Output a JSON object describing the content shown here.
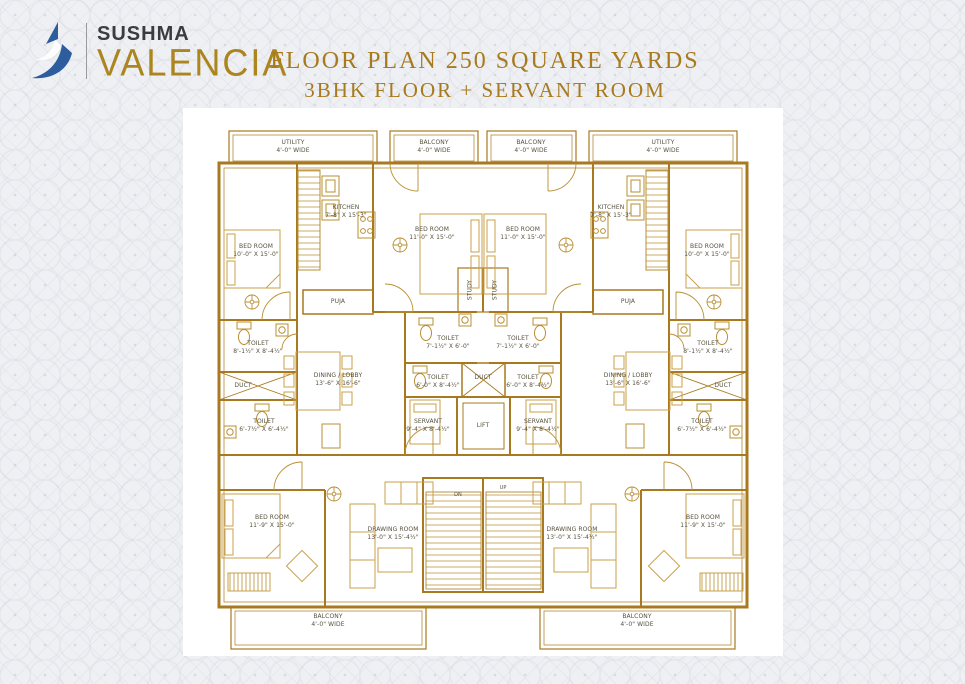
{
  "header": {
    "brand_top": "SUSHMA",
    "brand_bottom": "VALENCIA",
    "title_line1": "FLOOR PLAN 250 SQUARE YARDS",
    "title_line2": "3BHK FLOOR + SERVANT ROOM",
    "colors": {
      "brand_blue": "#2e5d9e",
      "gold": "#a87a1e",
      "brand_dark": "#3c3c3e"
    }
  },
  "plan": {
    "colors": {
      "wall": "#a9791f",
      "furniture": "#c9a14a",
      "label_text": "#56503d",
      "background": "#ffffff"
    },
    "rooms": {
      "utility": {
        "name": "UTILITY",
        "dims": "4'-0\" WIDE"
      },
      "balcony": {
        "name": "BALCONY",
        "dims": "4'-0\" WIDE"
      },
      "bed_corner": {
        "name": "BED ROOM",
        "dims": "10'-0\" X 15'-0\""
      },
      "kitchen": {
        "name": "KITCHEN",
        "dims": "7'-8\" X 15'-3\""
      },
      "bed_mid": {
        "name": "BED ROOM",
        "dims": "11'-0\" X 15'-0\""
      },
      "puja": {
        "name": "PUJA"
      },
      "study": {
        "name": "STUDY"
      },
      "toilet_ensuite": {
        "name": "TOILET",
        "dims": "8'-1½\" X 8'-4½\""
      },
      "duct": {
        "name": "DUCT"
      },
      "toilet_small": {
        "name": "TOILET",
        "dims": "6'-7½\" X 6'-4½\""
      },
      "dining": {
        "name": "DINING / LOBBY",
        "dims": "13'-6\" X 16'-6\""
      },
      "toilet_common": {
        "name": "TOILET",
        "dims": "7'-1½\" X 6'-0\""
      },
      "toilet_center": {
        "name": "TOILET",
        "dims": "6'-0\" X 8'-4½\""
      },
      "servant": {
        "name": "SERVANT",
        "dims": "9'-4\" X 8'-4½\""
      },
      "lift": {
        "name": "LIFT"
      },
      "stairs_dn": {
        "name": "DN"
      },
      "stairs_up": {
        "name": "UP"
      },
      "bed_bottom": {
        "name": "BED ROOM",
        "dims": "11'-9\" X 15'-0\""
      },
      "drawing": {
        "name": "DRAWING ROOM",
        "dims": "13'-0\" X 15'-4½\""
      }
    }
  }
}
